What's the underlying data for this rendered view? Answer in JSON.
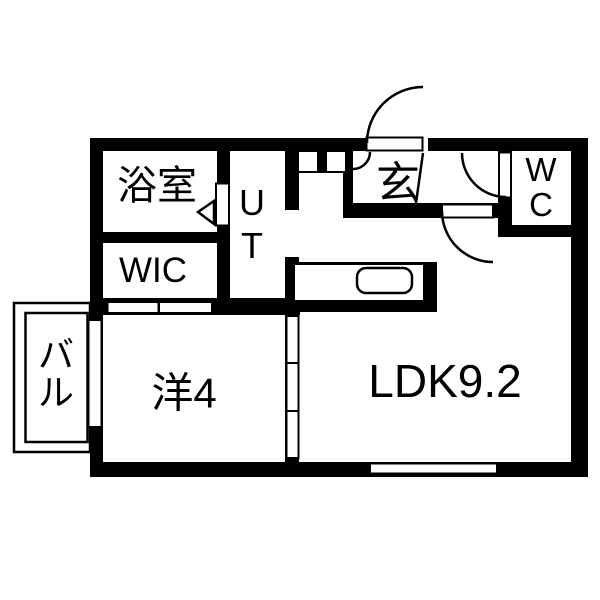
{
  "plan": {
    "type": "apartment-floor-plan",
    "rooms": {
      "bathroom": {
        "label": "浴室"
      },
      "utility": {
        "line1": "U",
        "line2": "T"
      },
      "wic": {
        "label": "WIC"
      },
      "genkan": {
        "label": "玄"
      },
      "wc": {
        "line1": "W",
        "line2": "C"
      },
      "western": {
        "label": "洋4"
      },
      "ldk": {
        "label": "LDK9.2"
      },
      "balcony": {
        "line1": "バ",
        "line2": "ル"
      }
    },
    "colors": {
      "wall": "#000000",
      "floor": "#ffffff",
      "line": "#000000"
    }
  }
}
